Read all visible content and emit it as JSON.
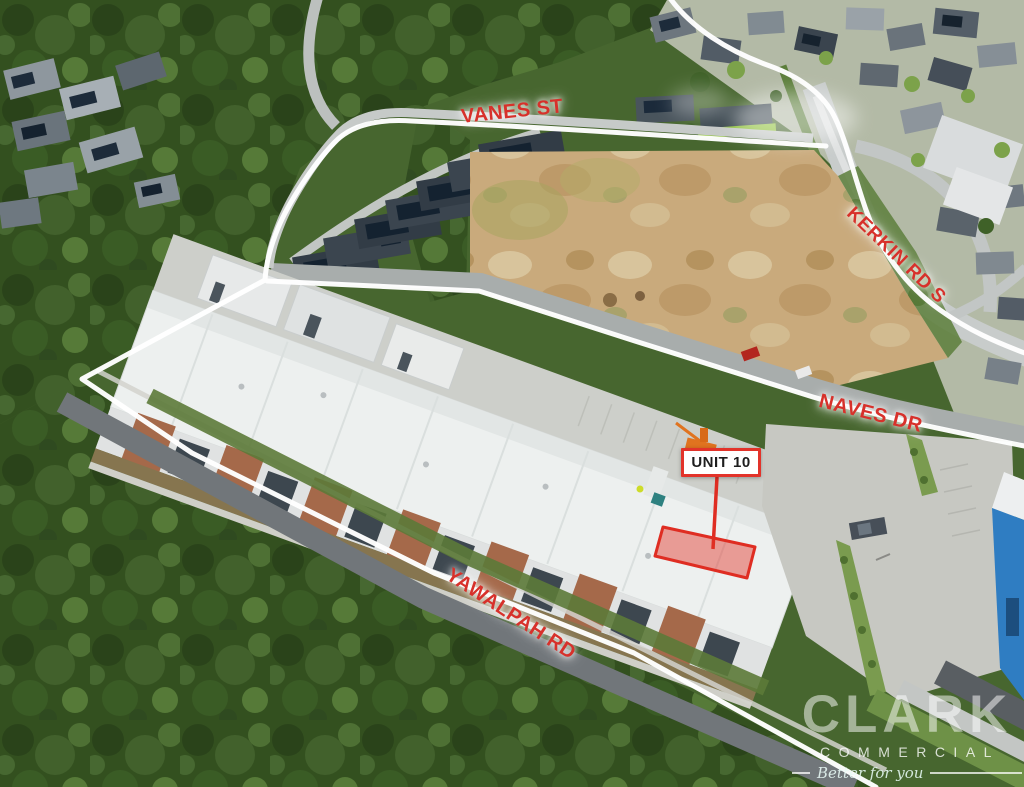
{
  "streets": [
    {
      "label": "VANES ST"
    },
    {
      "label": "KERKIN RD S"
    },
    {
      "label": "NAVES DR"
    },
    {
      "label": "YAWALPAH RD"
    }
  ],
  "unit_callout": {
    "label": "UNIT 10"
  },
  "watermark": {
    "brand": "CLARK",
    "division": "COMMERCIAL",
    "tagline": "Better for you"
  },
  "colors": {
    "annotation_red": "#d7312b",
    "boundary_line_white": "#ffffff",
    "unit_highlight_stroke": "#df2d22",
    "unit_highlight_fill": "rgba(227,50,40,0.45)"
  }
}
